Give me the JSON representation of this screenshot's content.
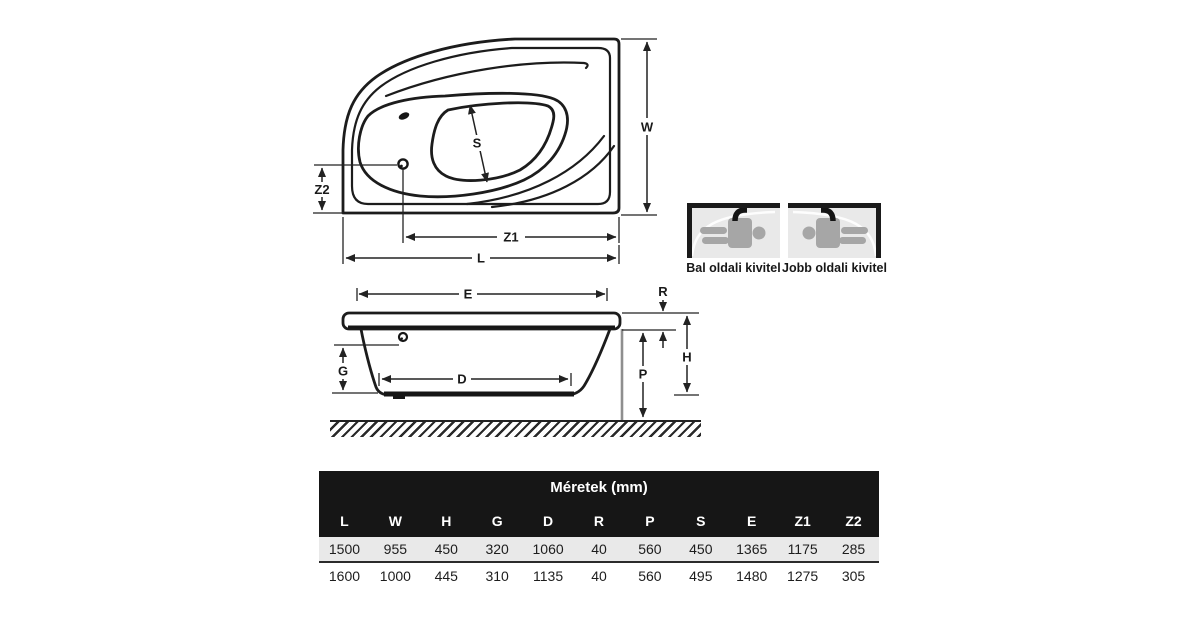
{
  "background": "#ffffff",
  "diagram": {
    "top_view": {
      "description": "corner bathtub top view",
      "labels": {
        "w": "W",
        "s": "S",
        "z1": "Z1",
        "z2": "Z2",
        "l": "L"
      }
    },
    "side_view": {
      "description": "bathtub side elevation",
      "labels": {
        "e": "E",
        "r": "R",
        "h": "H",
        "p": "P",
        "g": "G",
        "d": "D"
      }
    }
  },
  "pictograms": {
    "left": {
      "label": "Bal oldali kivitel"
    },
    "right": {
      "label": "Jobb oldali kivitel"
    }
  },
  "table": {
    "title": "Méretek (mm)",
    "columns": [
      "L",
      "W",
      "H",
      "G",
      "D",
      "R",
      "P",
      "S",
      "E",
      "Z1",
      "Z2"
    ],
    "rows": [
      [
        "1500",
        "955",
        "450",
        "320",
        "1060",
        "40",
        "560",
        "450",
        "1365",
        "1175",
        "285"
      ],
      [
        "1600",
        "1000",
        "445",
        "310",
        "1135",
        "40",
        "560",
        "495",
        "1480",
        "1275",
        "305"
      ]
    ]
  },
  "colors": {
    "line": "#1c1c1c",
    "table_header_bg": "#161616",
    "table_header_text": "#ffffff",
    "row_alt_bg": "#e9e9e9",
    "person_gray": "#a6a6a6",
    "picto_bg": "#e9e9e9",
    "panel_line_gray": "#8f8f8f"
  }
}
